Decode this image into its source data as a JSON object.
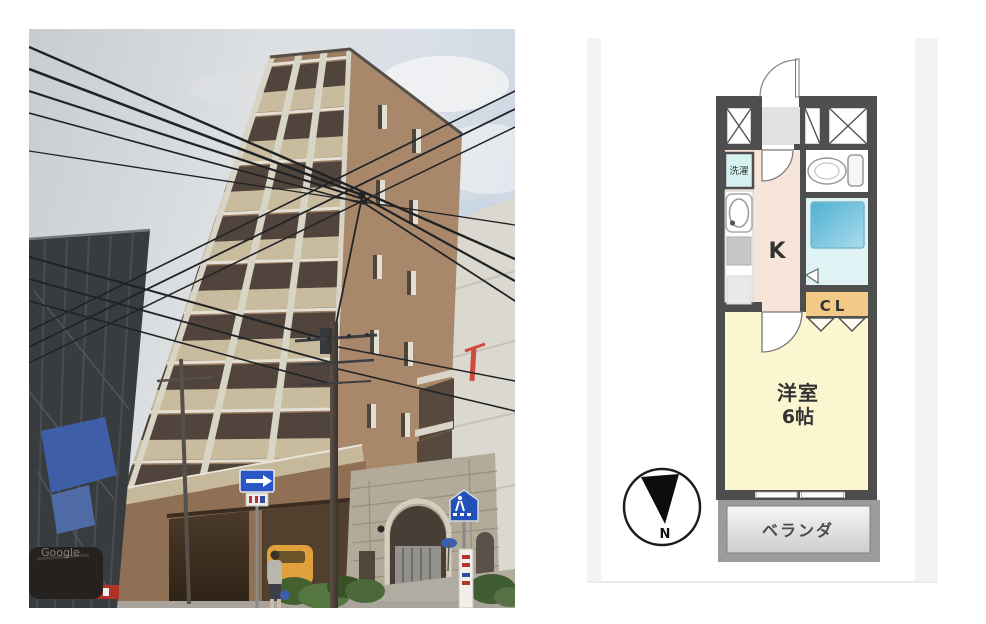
{
  "page": {
    "background": "#ffffff"
  },
  "building_photo": {
    "watermark": "Google",
    "icons": [
      "one-way-sign-icon",
      "pedestrian-crossing-sign-icon",
      "utility-pole",
      "crane-icon"
    ],
    "colors": {
      "sky": "#d3d8dd",
      "facade_brick": "#9c7d61",
      "facade_trim": "#d8d4c6",
      "parapet_beige": "#c9bb9e",
      "scaffold_building": "#393c3f",
      "tarp_blue": "#3f62b0",
      "stone_base": "#b3ab99",
      "one_way_sign_blue": "#2a56c6"
    }
  },
  "floor_plan": {
    "labels": {
      "entrance": "玄",
      "laundry": "洗濯",
      "kitchen": "K",
      "closet": "CL",
      "room_type": "洋室",
      "room_size": "6帖",
      "balcony": "ベランダ",
      "compass_north": "N"
    },
    "colors": {
      "wall": "#4e4e4e",
      "kitchen_floor": "#f8e5da",
      "room_floor": "#fcf6d0",
      "closet": "#f2c987",
      "bath": "#dff3f5",
      "bathtub": "#56b4d4",
      "laundry": "#d8f2f2",
      "entrance_floor": "#e2e2e2",
      "balcony_floor": "#ececec",
      "balcony_frame": "#9b9b9b"
    }
  }
}
